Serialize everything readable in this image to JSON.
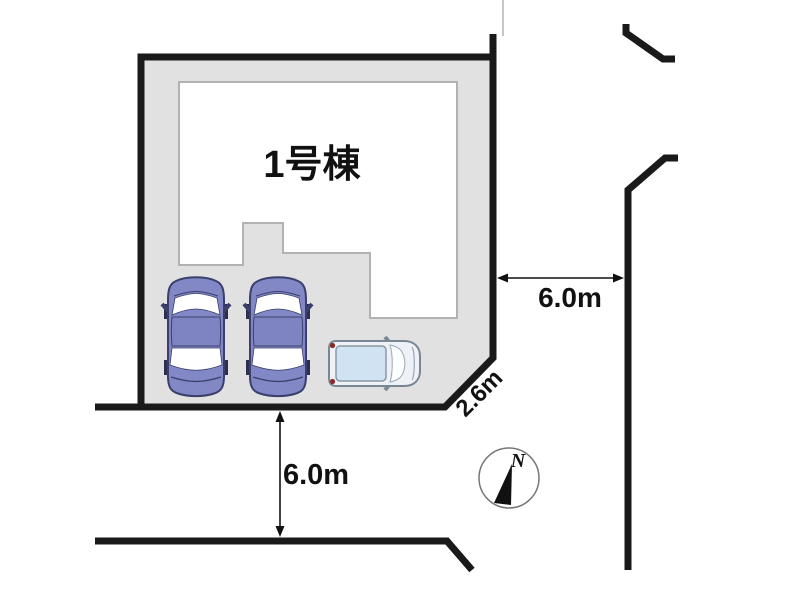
{
  "site_plan": {
    "building": {
      "label": "1号棟"
    },
    "dimensions": {
      "right_road_width": "6.0m",
      "bottom_road_width": "6.0m",
      "corner_chamfer": "2.6m"
    },
    "compass": {
      "north": "N"
    },
    "vehicles": [
      {
        "type": "sedan",
        "color_name": "purple"
      },
      {
        "type": "sedan",
        "color_name": "purple"
      },
      {
        "type": "minivan",
        "color_name": "white"
      }
    ],
    "colors": {
      "plot_fill": "#e1e1e1",
      "outline": "#1a1a1a",
      "building_fill": "#ffffff",
      "building_stroke": "#b2b2b2",
      "sedan_body": "#8287c6",
      "sedan_roof": "#7e83c2",
      "sedan_outline": "#3a3f6b",
      "van_body": "#eef2f7",
      "van_roof": "#cfe3f2",
      "van_outline": "#7b8695",
      "tail_light": "#8c2a2a",
      "neighbor_boundary": "#c6c6c6"
    }
  }
}
